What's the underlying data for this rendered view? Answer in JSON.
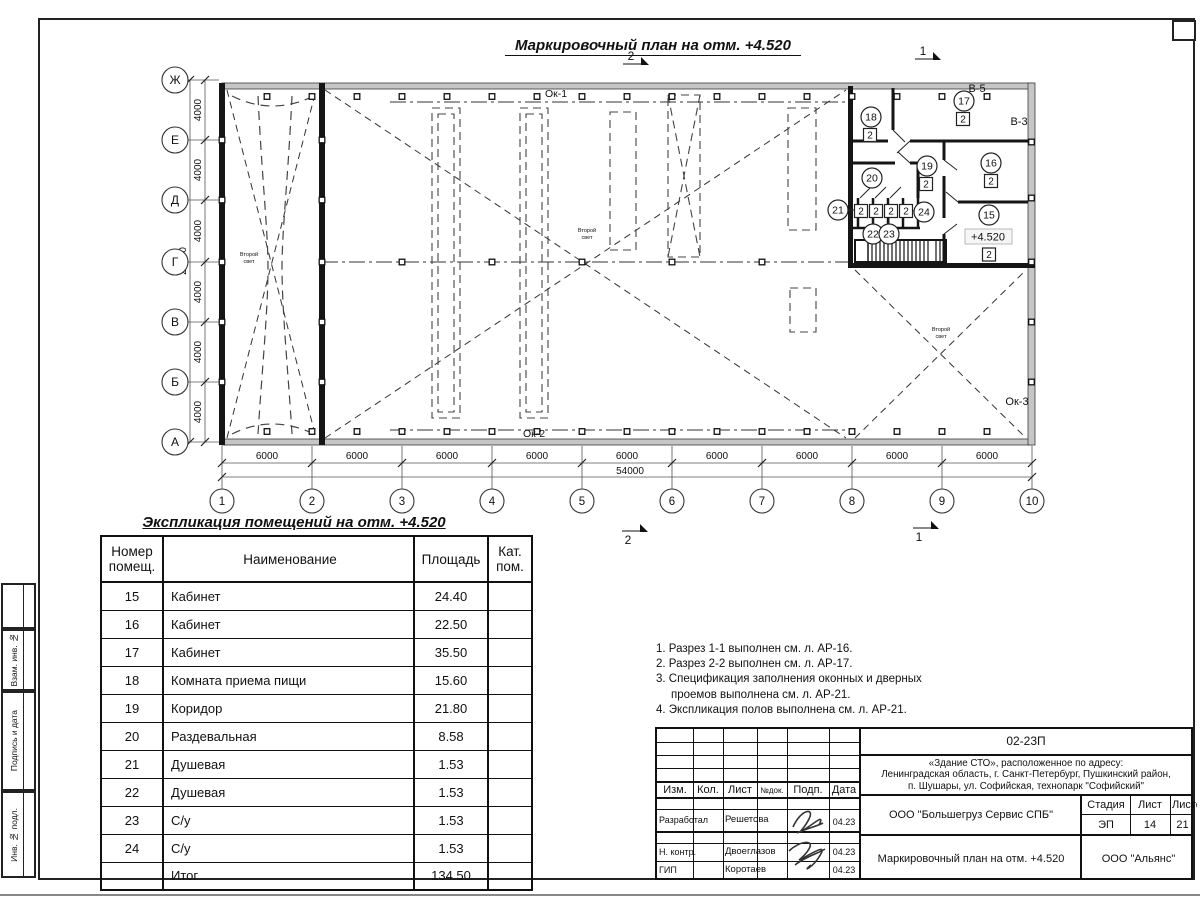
{
  "sheet": {
    "plan_title": "Маркировочный план на отм. +4.520"
  },
  "plan": {
    "axes_vertical": [
      "Ж",
      "Е",
      "Д",
      "Г",
      "В",
      "Б",
      "А"
    ],
    "axes_horizontal": [
      "1",
      "2",
      "3",
      "4",
      "5",
      "6",
      "7",
      "8",
      "9",
      "10"
    ],
    "dim_bays_bottom": [
      "6000",
      "6000",
      "6000",
      "6000",
      "6000",
      "6000",
      "6000",
      "6000",
      "6000"
    ],
    "dim_total_bottom": "54000",
    "dim_bays_left": [
      "4000",
      "4000",
      "4000",
      "4000",
      "4000",
      "4000"
    ],
    "dim_total_left": "24000",
    "section_markers": [
      "1",
      "2"
    ],
    "labels": {
      "ok1": "Ок-1",
      "ok2": "Ок-2",
      "ok3": "Ок-3",
      "v5": "В-5",
      "v3": "В-3",
      "second_light_l1": "Второй",
      "second_light_l2": "свет",
      "elevation": "+4.520"
    },
    "room_marks": [
      {
        "no": "15",
        "cat": "2"
      },
      {
        "no": "16",
        "cat": "2"
      },
      {
        "no": "17",
        "cat": "2"
      },
      {
        "no": "18",
        "cat": "2"
      },
      {
        "no": "19",
        "cat": "2"
      },
      {
        "no": "20",
        "cat": ""
      },
      {
        "no": "21",
        "cat": "2"
      },
      {
        "no": "22",
        "cat": "2"
      },
      {
        "no": "23",
        "cat": "2"
      },
      {
        "no": "24",
        "cat": "2"
      }
    ]
  },
  "schedule": {
    "title": "Экспликация помещений на отм. +4.520",
    "headers": [
      "Номер\nпомещ.",
      "Наименование",
      "Площадь",
      "Кат.\nпом."
    ],
    "rows": [
      [
        "15",
        "Кабинет",
        "24.40",
        ""
      ],
      [
        "16",
        "Кабинет",
        "22.50",
        ""
      ],
      [
        "17",
        "Кабинет",
        "35.50",
        ""
      ],
      [
        "18",
        "Комната приема пищи",
        "15.60",
        ""
      ],
      [
        "19",
        "Коридор",
        "21.80",
        ""
      ],
      [
        "20",
        "Раздевальная",
        "8.58",
        ""
      ],
      [
        "21",
        "Душевая",
        "1.53",
        ""
      ],
      [
        "22",
        "Душевая",
        "1.53",
        ""
      ],
      [
        "23",
        "С/у",
        "1.53",
        ""
      ],
      [
        "24",
        "С/у",
        "1.53",
        ""
      ]
    ],
    "total_label": "Итог",
    "total_value": "134.50"
  },
  "notes": [
    "1. Разрез 1-1 выполнен см. л. АР-16.",
    "2. Разрез 2-2 выполнен см. л. АР-17.",
    "3. Спецификация заполнения оконных и дверных проемов выполнена см. л. АР-21.",
    "4. Экспликация полов выполнена см. л. АР-21."
  ],
  "titleblock": {
    "doc_code": "02-23П",
    "address_l1": "«Здание СТО», расположенное по адресу:",
    "address_l2": "Ленинградская область, г. Санкт-Петербург, Пушкинский район,",
    "address_l3": "п. Шушары, ул. Софийская, технопарк \"Софийский\"",
    "col_izm": "Изм.",
    "col_kol": "Кол.",
    "col_list": "Лист",
    "col_ndoc": "№док.",
    "col_podp": "Подп.",
    "col_data": "Дата",
    "role_1": "Разработал",
    "name_1": "Решетова",
    "date_1": "04.23",
    "role_2": "Н. контр.",
    "name_2": "Двоеглазов",
    "date_2": "04.23",
    "role_3": "ГИП",
    "name_3": "Коротаев",
    "date_3": "04.23",
    "company": "ООО \"Большегруз Сервис СПБ\"",
    "stage_label": "Стадия",
    "sheet_label": "Лист",
    "sheets_label": "Листов",
    "stage": "ЭП",
    "sheet_no": "14",
    "sheets_total": "21",
    "drawing_title": "Маркировочный план на отм. +4.520",
    "org": "ООО \"Альянс\""
  },
  "side_stamp": {
    "label_1": "Взам. инв. №",
    "label_2": "Подпись и дата",
    "label_3": "Инв. № подл."
  }
}
